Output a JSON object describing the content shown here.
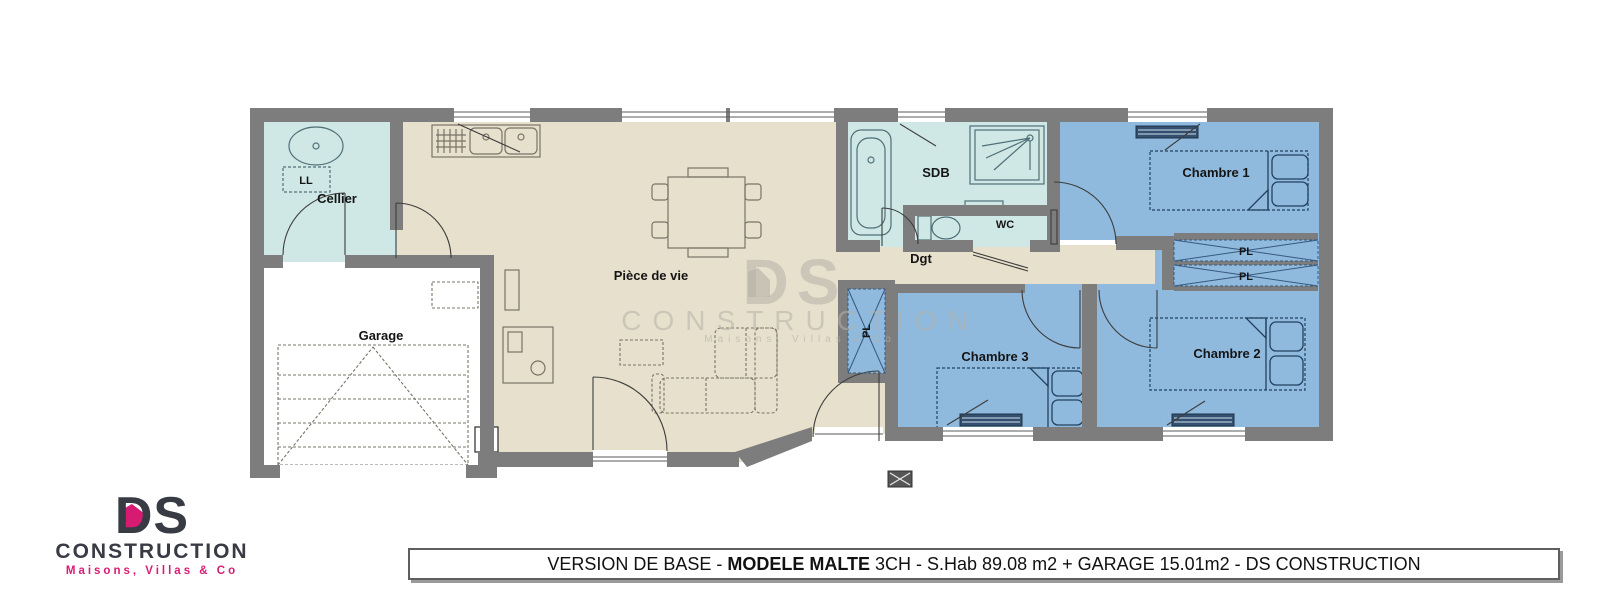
{
  "rooms": {
    "cellier": "Cellier",
    "garage": "Garage",
    "piece_de_vie": "Pièce de vie",
    "sdb": "SDB",
    "wc": "WC",
    "dgt": "Dgt",
    "chambre1": "Chambre 1",
    "chambre2": "Chambre 2",
    "chambre3": "Chambre 3",
    "pl": "PL",
    "ll": "LL"
  },
  "watermark": {
    "monogram": "DS",
    "name": "CONSTRUCTION",
    "tagline": "Maisons,  Villas  &  Co"
  },
  "logo": {
    "monogram": "DS",
    "name": "CONSTRUCTION",
    "tagline": "Maisons, Villas & Co"
  },
  "banner": {
    "part1": "VERSION DE BASE - ",
    "part2": "MODELE MALTE",
    "part3": " 3CH - S.Hab 89.08 m2 + GARAGE 15.01m2 - DS CONSTRUCTION"
  },
  "colors": {
    "wall": "#7d7d7d",
    "living_floor": "#e7e0cc",
    "wet_floor": "#cfe8e6",
    "bedroom_floor": "#8fbadd",
    "accent_pink": "#d81b72",
    "logo_dark": "#383b44"
  }
}
